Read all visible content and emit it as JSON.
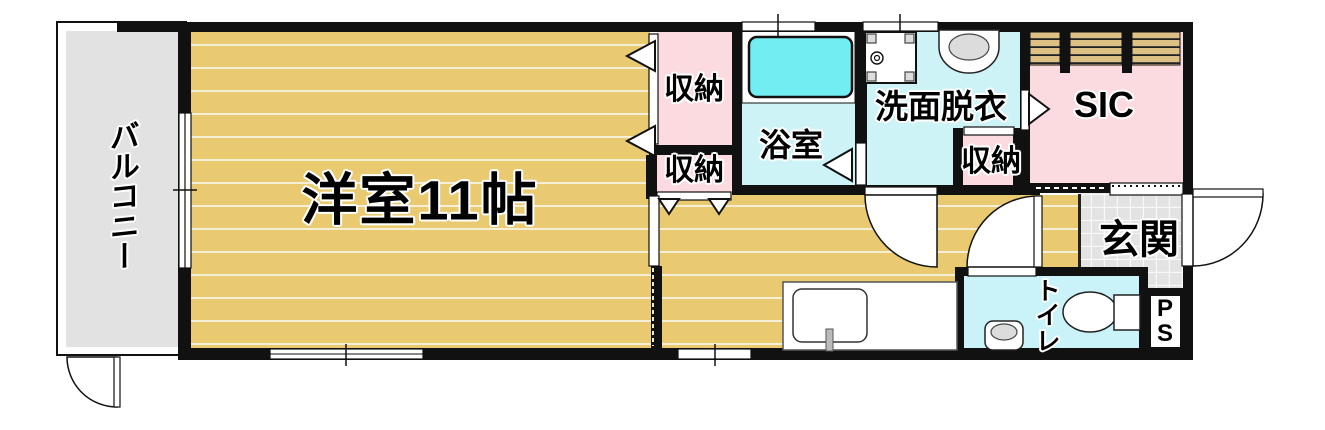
{
  "labels": {
    "balcony": "バルコニー",
    "western_room": "洋室11帖",
    "closet_main_top": "収納",
    "closet_main_bottom": "収納",
    "bathroom": "浴室",
    "washroom": "洗面脱衣",
    "washroom_closet": "収納",
    "shoe_closet": "SIC",
    "entrance": "玄関",
    "toilet": "トイレ",
    "pipe_space": [
      "P",
      "S"
    ]
  },
  "colors": {
    "wall": "#111111",
    "floor-tan": "#e9ca70",
    "floor-line": "#f6efd8",
    "room-pink": "#fbdbdf",
    "room-cyan": "#cdf3f7",
    "toilet-cyan": "#c9f3f8",
    "bathtub-cyan": "#72edf2",
    "balcony-gray": "#e2e2e2",
    "tile-gray": "#e3e3e3",
    "shelf-tan": "#dcc086",
    "fixture-gray": "#dcdcdc"
  }
}
